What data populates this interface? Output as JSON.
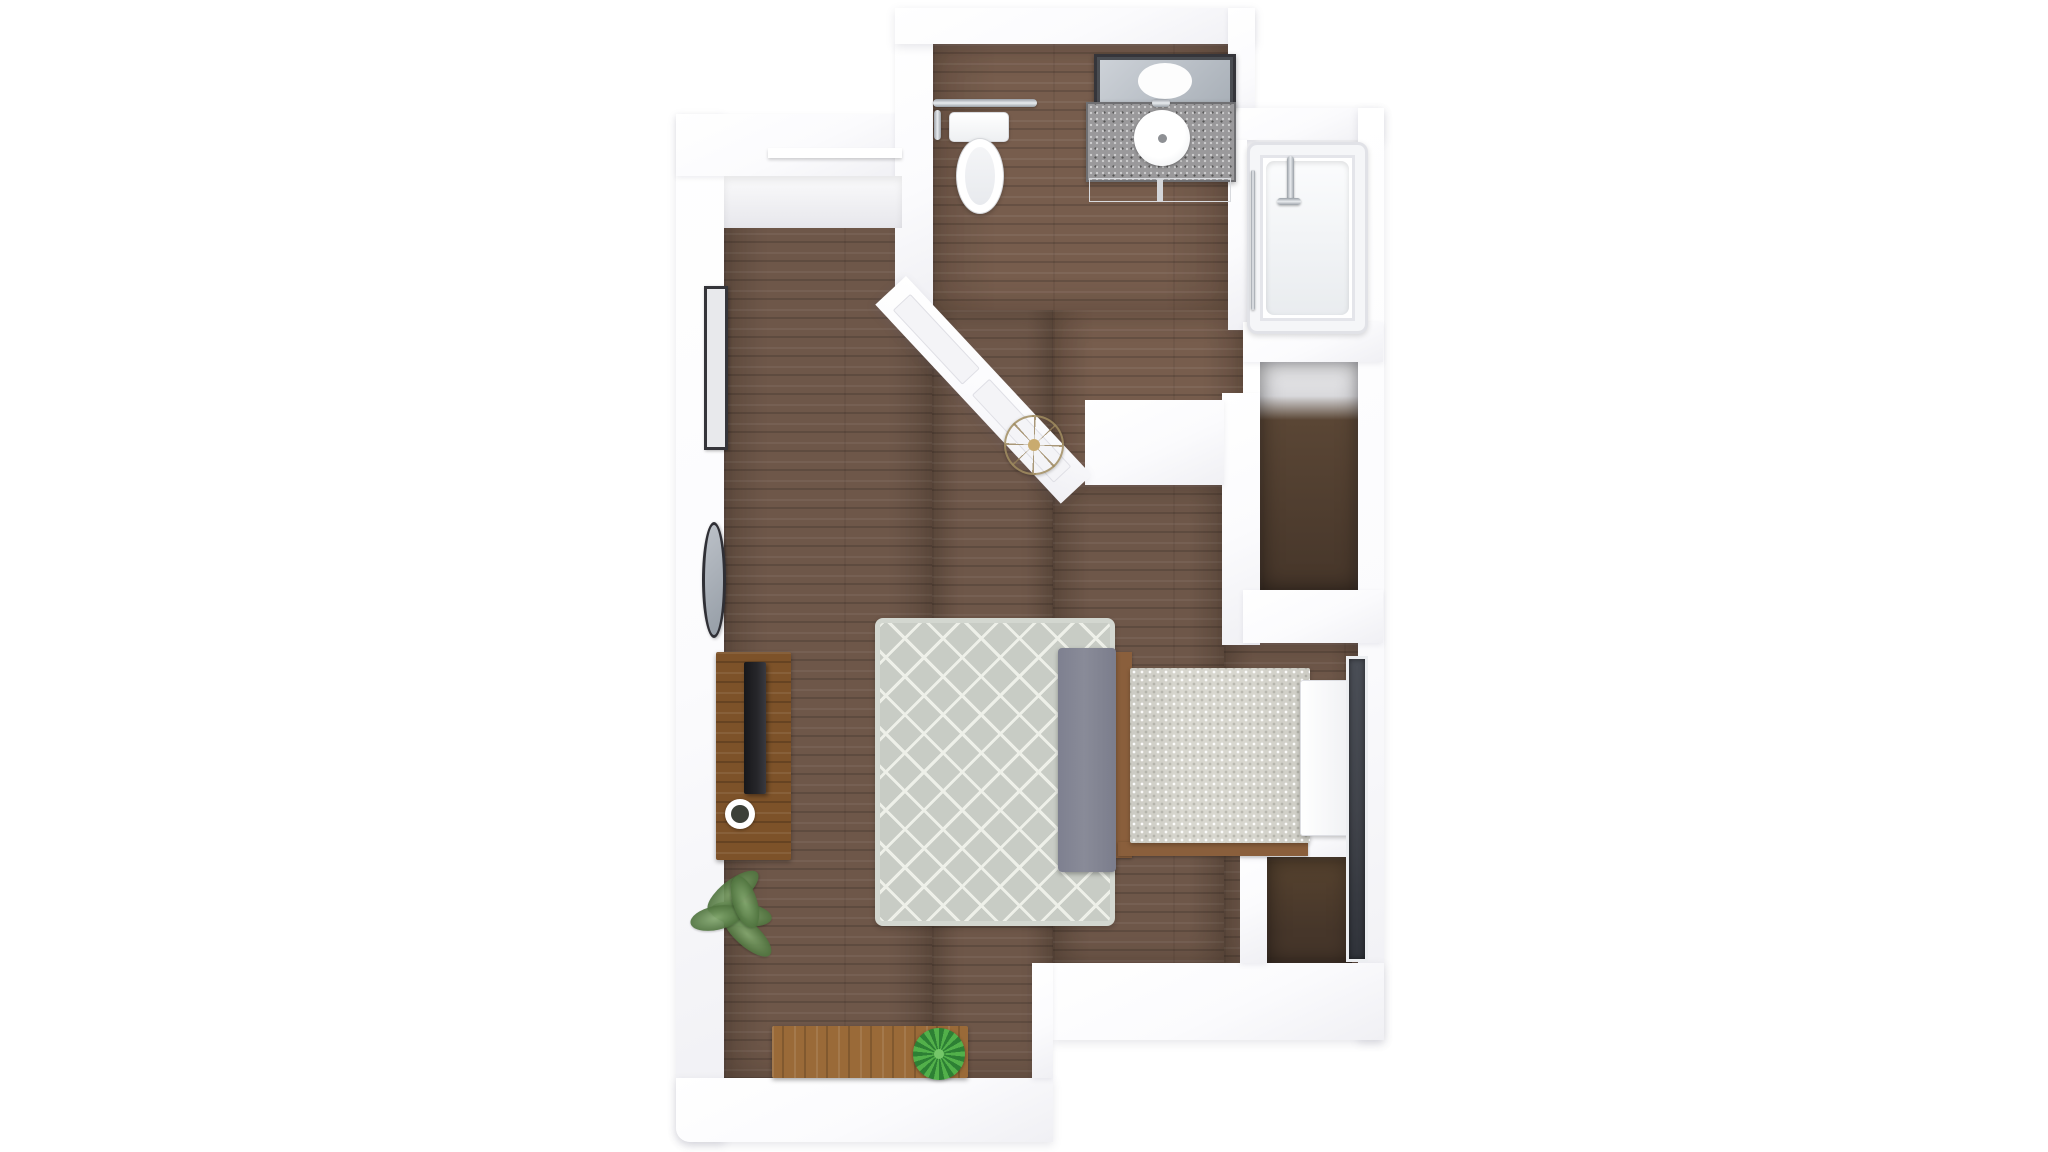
{
  "meta": {
    "title": "studio-apartment-3d-floor-plan",
    "view": "top-down 3D dollhouse render",
    "visible_text": []
  },
  "palette": {
    "wall_fill": "#fbfbfd",
    "floor": "#6e5749",
    "closet_floor_top": "#ededef",
    "closet_floor_dark": "#46362a",
    "rug": "#c8ccc5",
    "rug_line": "#eef0e9",
    "headboard": "#898b98",
    "bedding": "#d8d7cf",
    "bed_frame": "#8a5f3c",
    "console_wood": "#7d5229",
    "bench_wood": "#9a6a38",
    "tv": "#26262a",
    "counter": "#9a999b",
    "frame_dark": "#35353a",
    "window": "#41444b",
    "light_gold": "#c9ab6f",
    "chrome": "#c7cbd0",
    "plant_green": "#5f8551",
    "succulent_green": "#3c9a40"
  },
  "scene": {
    "rooms": [
      {
        "name": "entry-nook",
        "feature": "coat closet with shelf"
      },
      {
        "name": "bathroom",
        "fixtures": [
          "toilet",
          "grab-bar",
          "vanity-with-vessel-sink",
          "leaning-mirror",
          "bathtub"
        ]
      },
      {
        "name": "living-sleeping-area",
        "furniture": [
          "tv-console",
          "tv",
          "mug",
          "area-rug",
          "bed",
          "foot-dresser",
          "wood-bench",
          "fern-plant",
          "succulent-plant",
          "wall-art",
          "oval-mirror",
          "pendant-light"
        ]
      },
      {
        "name": "walk-in-closet-upper",
        "feature": "dark wood floor"
      },
      {
        "name": "closet-lower-right",
        "feature": "dark wood floor"
      }
    ],
    "structure": {
      "wall_color": "white",
      "floor_material": "walnut plank",
      "angled_wall": "wainscoted partition between living area and bathroom",
      "window_wall": "right side next to bed"
    }
  }
}
